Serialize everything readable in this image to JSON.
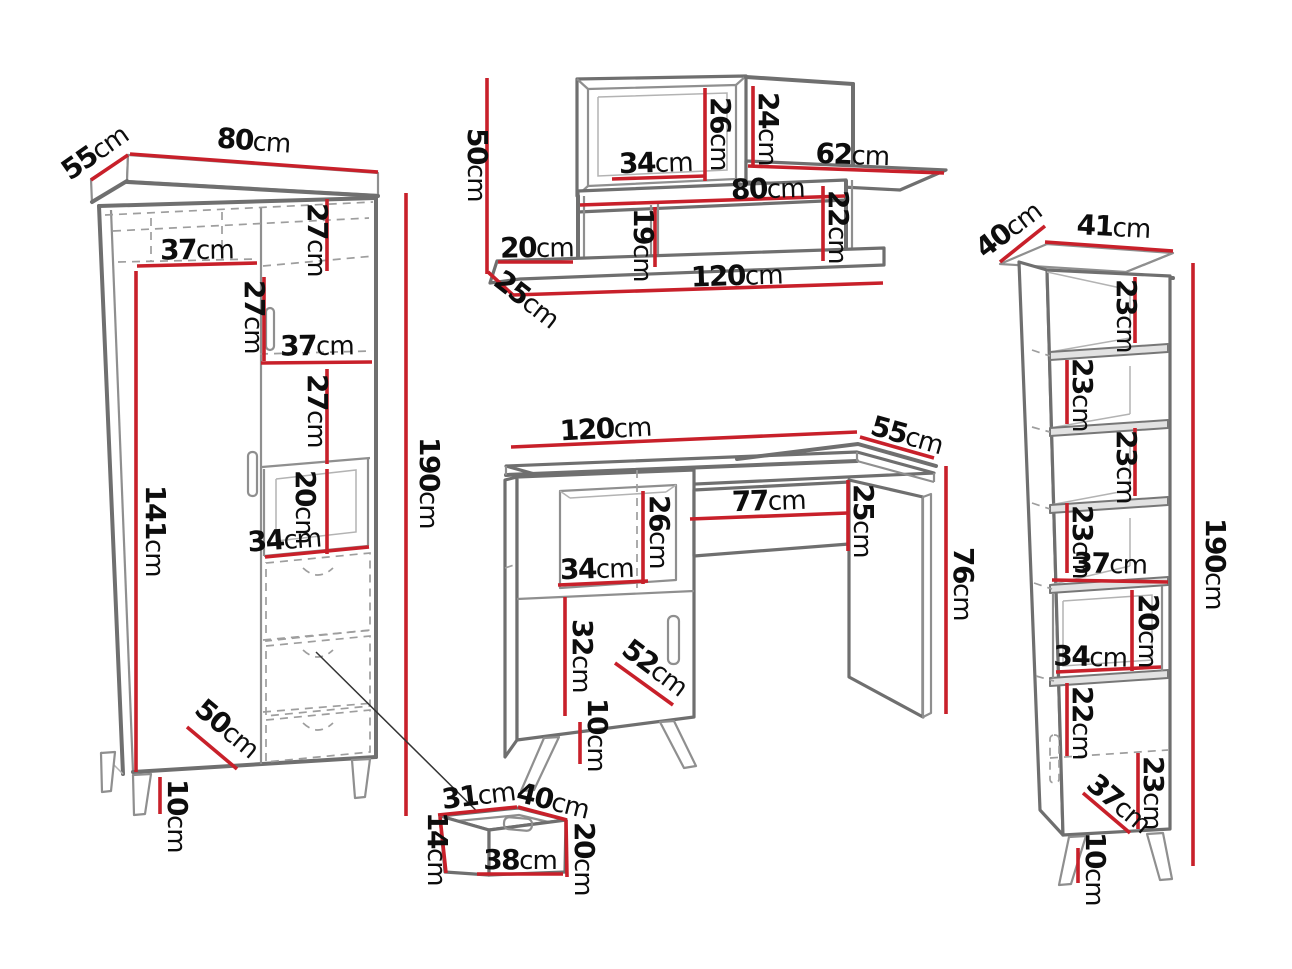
{
  "diagram": {
    "type": "furniture-dimension-diagram",
    "unit": "cm",
    "background": "#ffffff"
  },
  "colors": {
    "dimension_line": "#c8202a",
    "furniture_edge": "#6f6f6f",
    "hidden_line": "#9e9e9e",
    "label_text": "#0d0d0d"
  },
  "pieces": {
    "wardrobe": {
      "name": "wardrobe",
      "width": "80cm",
      "depth": "55cm",
      "height": "190cm",
      "shelf_width_top": "37cm",
      "section_height_a": "27cm",
      "section_height_b": "27cm",
      "shelf_width_mid": "37cm",
      "section_height_c": "27cm",
      "cubby_height": "20cm",
      "cubby_width": "34cm",
      "hanging_height": "141cm",
      "base_depth": "50cm",
      "leg_height": "10cm"
    },
    "wall_shelf": {
      "name": "wall-shelf",
      "height": "50cm",
      "width": "120cm",
      "depth": "25cm",
      "cabinet_height": "26cm",
      "cabinet_width": "34cm",
      "right_opening_height": "24cm",
      "top_shelf_length": "62cm",
      "middle_shelf_length": "80cm",
      "right_gap_height": "22cm",
      "divider_height": "19cm",
      "left_shelf_length": "20cm"
    },
    "desk": {
      "name": "desk",
      "width": "120cm",
      "depth": "55cm",
      "height": "76cm",
      "knee_space_width": "77cm",
      "apron_height": "25cm",
      "compartment_height": "26cm",
      "compartment_width": "34cm",
      "door_height": "32cm",
      "door_width": "52cm",
      "leg_height": "10cm"
    },
    "bookcase": {
      "name": "bookcase",
      "width": "41cm",
      "depth": "40cm",
      "height": "190cm",
      "shelf_gap_1": "23cm",
      "shelf_gap_2": "23cm",
      "shelf_gap_3": "23cm",
      "shelf_gap_4": "23cm",
      "shelf_width": "37cm",
      "cubby_height": "20cm",
      "cubby_width": "34cm",
      "gap_below_cubby": "22cm",
      "bottom_gap": "23cm",
      "base_depth": "37cm",
      "leg_height": "10cm"
    },
    "drawer_box": {
      "name": "drawer-box",
      "side_depth": "31cm",
      "top_width": "40cm",
      "side_height": "14cm",
      "front_width": "38cm",
      "total_height": "20cm"
    }
  }
}
